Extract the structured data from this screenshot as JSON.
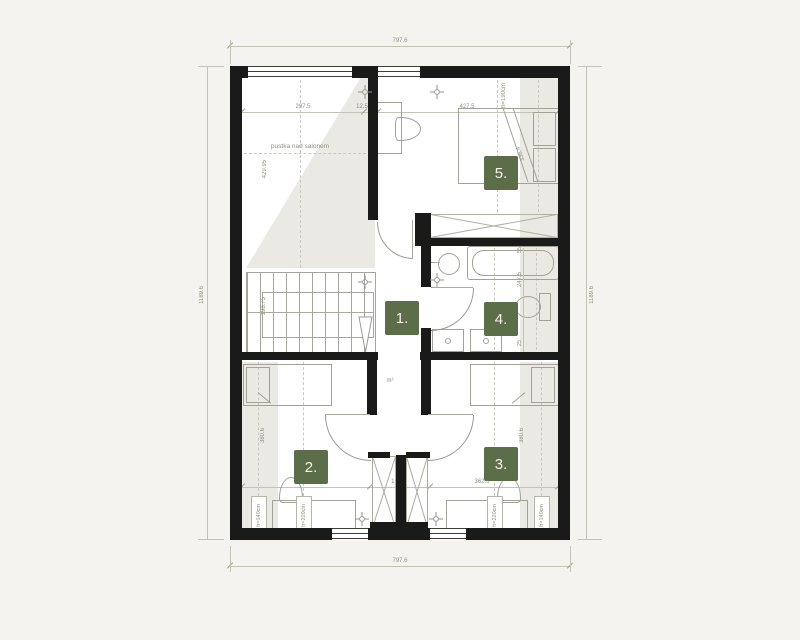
{
  "overall": {
    "width": "797.6",
    "height": "1189.6"
  },
  "top_dims": {
    "void_width": "297.5",
    "wall": "12.5",
    "bedroom5_width": "427.5"
  },
  "bottom_dims": {
    "room2_width": "362.5",
    "shaft": "12.5",
    "room3_width": "362.5"
  },
  "void": {
    "label": "pustka nad salonem",
    "height": "429.95"
  },
  "stairs": {
    "run": "198.75"
  },
  "hallway": {
    "number": "1.",
    "area_unit": "m²"
  },
  "room2": {
    "number": "2.",
    "height": "380.6",
    "h_low": "h=140cm",
    "h_high": "h=220cm"
  },
  "room3": {
    "number": "3.",
    "height": "380.6",
    "h_low": "h=140cm",
    "h_high": "h=220cm"
  },
  "bathroom": {
    "number": "4.",
    "height": "247.5",
    "seg_top": "55",
    "seg_bottom": "25"
  },
  "room5": {
    "number": "5.",
    "knee_height": "h=190cm",
    "bed_diagonal": "336.4"
  },
  "colors": {
    "accent_green": "#5c6e49",
    "wall": "#1a1a18",
    "background": "#f4f3ef"
  }
}
